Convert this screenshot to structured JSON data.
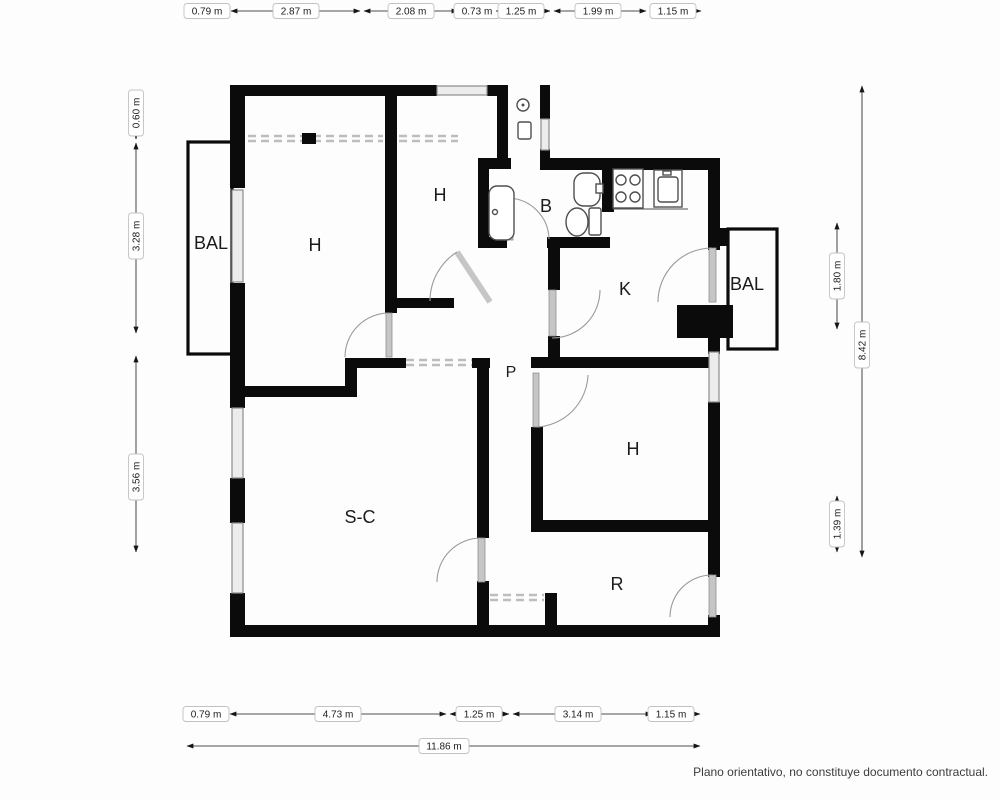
{
  "document": {
    "type": "floor-plan",
    "footer_disclaimer": "Plano orientativo, no constituye documento contractual."
  },
  "colors": {
    "wall": "#0b0b0b",
    "background": "#fdfdfd",
    "window": "#8c8c8c",
    "door": "#9a9a9a",
    "wardrobe_dash": "#bdbdbd",
    "dim_text": "#1c1c1c",
    "dim_box_border": "#c2c2c2"
  },
  "rooms": {
    "balcony_left": {
      "label": "BAL"
    },
    "bedroom_1": {
      "label": "H"
    },
    "bedroom_2": {
      "label": "H"
    },
    "bathroom": {
      "label": "B"
    },
    "kitchen": {
      "label": "K"
    },
    "balcony_right": {
      "label": "BAL"
    },
    "hallway": {
      "label": "P"
    },
    "bedroom_3": {
      "label": "H"
    },
    "living_dining": {
      "label": "S-C"
    },
    "room_r": {
      "label": "R"
    }
  },
  "icons": {
    "bathtub": "bathtub-icon",
    "toilet": "toilet-icon",
    "washbasin": "washbasin-icon",
    "shower": "shower-icon",
    "stove": "stove-icon",
    "kitchen_sink": "kitchen-sink-icon"
  },
  "dimensions": {
    "top": [
      {
        "label": "0.79 m",
        "value": 0.79
      },
      {
        "label": "2.87 m",
        "value": 2.87
      },
      {
        "label": "2.08 m",
        "value": 2.08
      },
      {
        "label": "0.73 m",
        "value": 0.73
      },
      {
        "label": "1.25 m",
        "value": 1.25
      },
      {
        "label": "1.99 m",
        "value": 1.99
      },
      {
        "label": "1.15 m",
        "value": 1.15
      }
    ],
    "left": [
      {
        "label": "0.60 m",
        "value": 0.6
      },
      {
        "label": "3.28 m",
        "value": 3.28
      },
      {
        "label": "3.56 m",
        "value": 3.56
      }
    ],
    "right_inner": [
      {
        "label": "1.80 m",
        "value": 1.8
      },
      {
        "label": "1.39 m",
        "value": 1.39
      }
    ],
    "right_total": {
      "label": "8.42 m",
      "value": 8.42
    },
    "bottom": [
      {
        "label": "0.79 m",
        "value": 0.79
      },
      {
        "label": "4.73 m",
        "value": 4.73
      },
      {
        "label": "1.25 m",
        "value": 1.25
      },
      {
        "label": "3.14 m",
        "value": 3.14
      },
      {
        "label": "1.15 m",
        "value": 1.15
      }
    ],
    "bottom_total": {
      "label": "11.86 m",
      "value": 11.86
    }
  }
}
